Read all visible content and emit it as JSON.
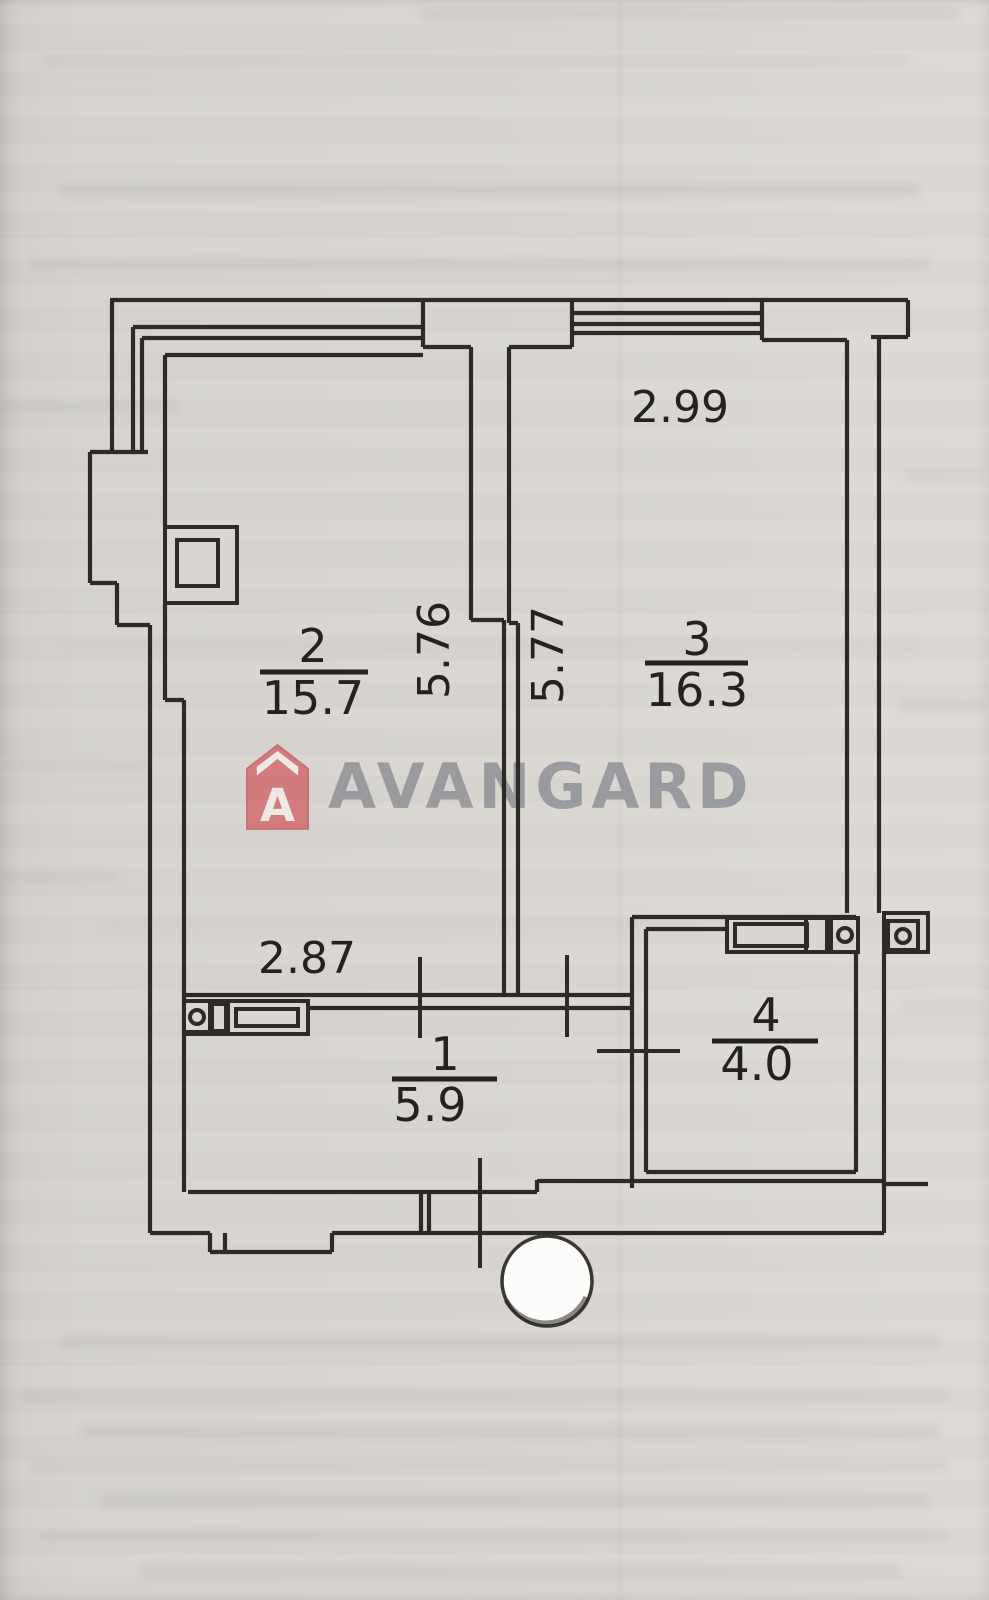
{
  "meta": {
    "description": "Scanned apartment floor plan (BTI style) with agency watermark and hole punch"
  },
  "watermark": {
    "brand": "AVANGARD",
    "icon": "house-badge-icon",
    "icon_letter": "A",
    "icon_color": "#d2686b",
    "text_color": "#6a707a"
  },
  "dimensions": {
    "room3_width": "2.99",
    "room2_depth": "5.76",
    "room3_depth": "5.77",
    "room2_width_lower": "2.87"
  },
  "rooms": [
    {
      "number": "1",
      "area": "5.9"
    },
    {
      "number": "2",
      "area": "15.7"
    },
    {
      "number": "3",
      "area": "16.3"
    },
    {
      "number": "4",
      "area": "4.0"
    }
  ],
  "colors": {
    "paper": "#d9d6d1",
    "ink": "#2e2b27",
    "logo_red": "#d2686b",
    "logo_gray": "#6a707a"
  },
  "artifacts": {
    "hole_punch": "white punched circle over bottom wall"
  }
}
